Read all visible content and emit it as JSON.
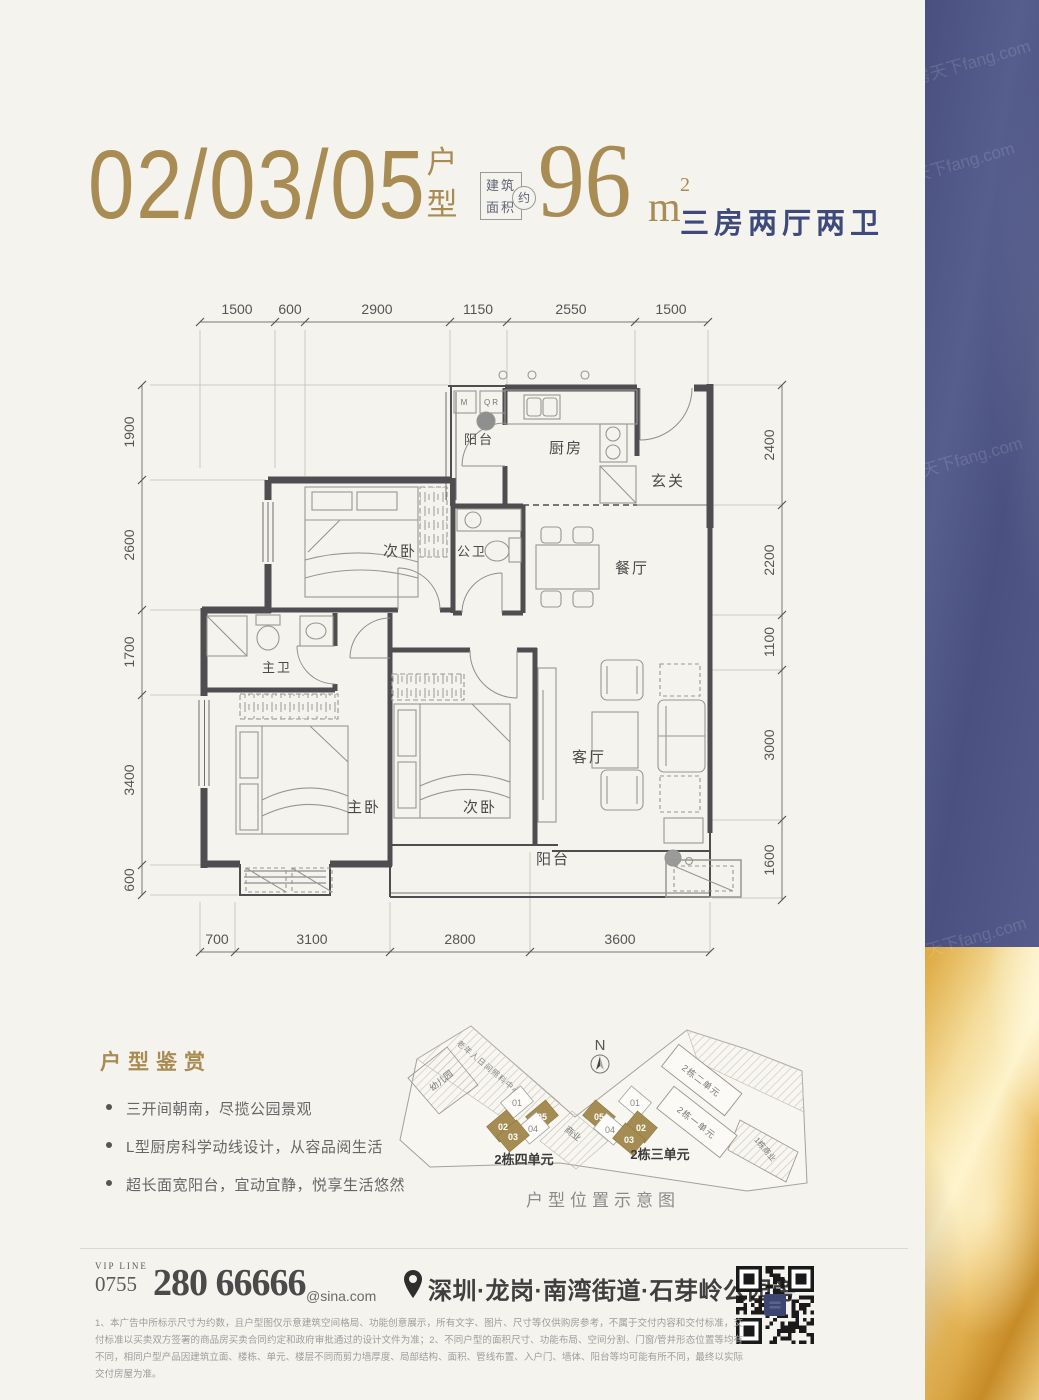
{
  "header": {
    "unit_numbers": "02/03/05",
    "unit_type_char1": "户",
    "unit_type_char2": "型",
    "area_prefix_top": "建筑",
    "area_prefix_bottom": "面积",
    "area_approx": "约",
    "area_value": "96",
    "area_unit": "m",
    "area_exponent": "2",
    "room_config": "三房两厅两卫"
  },
  "floorplan": {
    "dims_top": [
      "1500",
      "600",
      "2900",
      "1150",
      "2550",
      "1500"
    ],
    "dims_left": [
      "1900",
      "2600",
      "1700",
      "3400",
      "600"
    ],
    "dims_right": [
      "2400",
      "2200",
      "1100",
      "3000",
      "1600"
    ],
    "dims_bottom": [
      "700",
      "3100",
      "2800",
      "3600"
    ],
    "rooms": {
      "balcony_top": "阳台",
      "kitchen": "厨房",
      "foyer": "玄关",
      "bedroom2_top": "次卧",
      "bath_public": "公卫",
      "dining": "餐厅",
      "bath_master": "主卫",
      "bedroom_master": "主卧",
      "bedroom2_bottom": "次卧",
      "living": "客厅",
      "balcony_bottom": "阳台"
    },
    "equip_m": "M",
    "equip_qr": "QR"
  },
  "appreciation": {
    "title": "户型鉴赏",
    "bullets": [
      "三开间朝南，尽揽公园景观",
      "L型厨房科学动线设计，从容品阅生活",
      "超长面宽阳台，宜动宜静，悦享生活悠然"
    ]
  },
  "siteplan": {
    "caption": "户型位置示意图",
    "compass": "N",
    "kindergarten": "幼儿园",
    "eldercare": "老年人日间照料中心",
    "commerce": "商业",
    "cluster_left_label": "2栋四单元",
    "cluster_right_label": "2栋三单元",
    "building_label_1": "2栋二单元",
    "building_label_2": "2栋一单元",
    "building_label_3": "1栋商业",
    "units_left": [
      "01",
      "05",
      "04",
      "02",
      "03"
    ],
    "units_right": [
      "05",
      "04",
      "01",
      "02",
      "03"
    ]
  },
  "footer": {
    "vip_line_label": "VIP LINE",
    "area_code": "0755",
    "phone": "280 66666",
    "email": "@sina.com",
    "address": "深圳·龙岗·南湾街道·石芽岭公园旁",
    "disclaimer": "1、本广告中所标示尺寸为约数，且户型图仅示意建筑空间格局、功能创意展示，所有文字、图片、尺寸等仅供购房参考，不属于交付内容和交付标准，交付标准以买卖双方签署的商品房买卖合同约定和政府审批通过的设计文件为准；2、不同户型的面积尺寸、功能布局、空间分割、门窗/管井形态位置等均有不同，相同户型产品因建筑立面、楼栋、单元、楼层不同而剪力墙厚度、局部结构、面积、管线布置、入户门、墙体、阳台等均可能有所不同，最终以实际交付房屋为准。"
  },
  "watermark": "房天下fang.com",
  "colors": {
    "gold": "#a98c53",
    "navy": "#3d4a7b",
    "band_navy": "#4f5787",
    "wall": "#4e4e50"
  }
}
